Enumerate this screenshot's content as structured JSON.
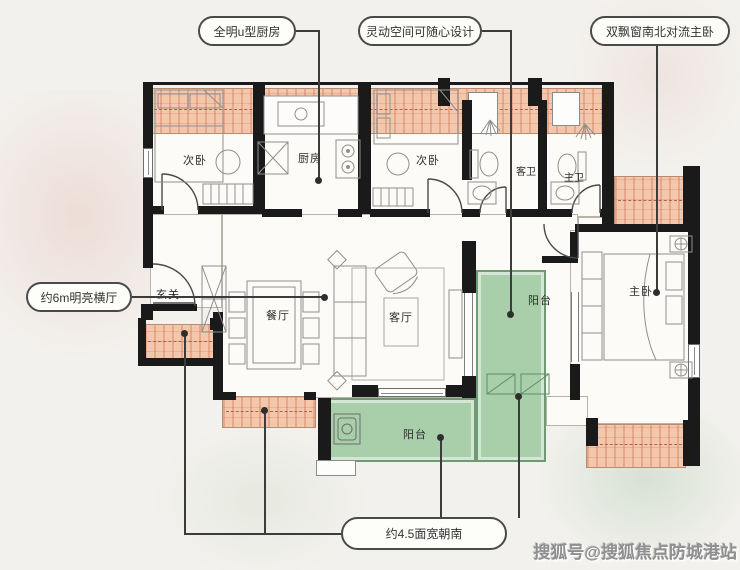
{
  "figure": {
    "kind": "apartment-floorplan"
  },
  "callouts": {
    "kitchen_label": "全明u型厨房",
    "flexible_label": "灵动空间可随心设计",
    "master_label": "双飘窗南北对流主卧",
    "hall_label": "约6m明亮横厅",
    "south_label": "约4.5面宽朝南"
  },
  "rooms": {
    "bedroom_left": "次卧",
    "kitchen": "厨房",
    "bedroom_mid": "次卧",
    "guest_bath": "客卫",
    "master_bath": "主卫",
    "entry": "玄关",
    "dining": "餐厅",
    "living": "客厅",
    "balcony_right": "阳台",
    "balcony_bottom": "阳台",
    "master_bedroom": "主卧"
  },
  "watermark": "搜狐号@搜狐焦点防城港站",
  "colors": {
    "bay": "#f3c7ac",
    "balcony": "#a8cfaa",
    "wall": "#1a1a1a",
    "callout": "#4a4a4a"
  }
}
